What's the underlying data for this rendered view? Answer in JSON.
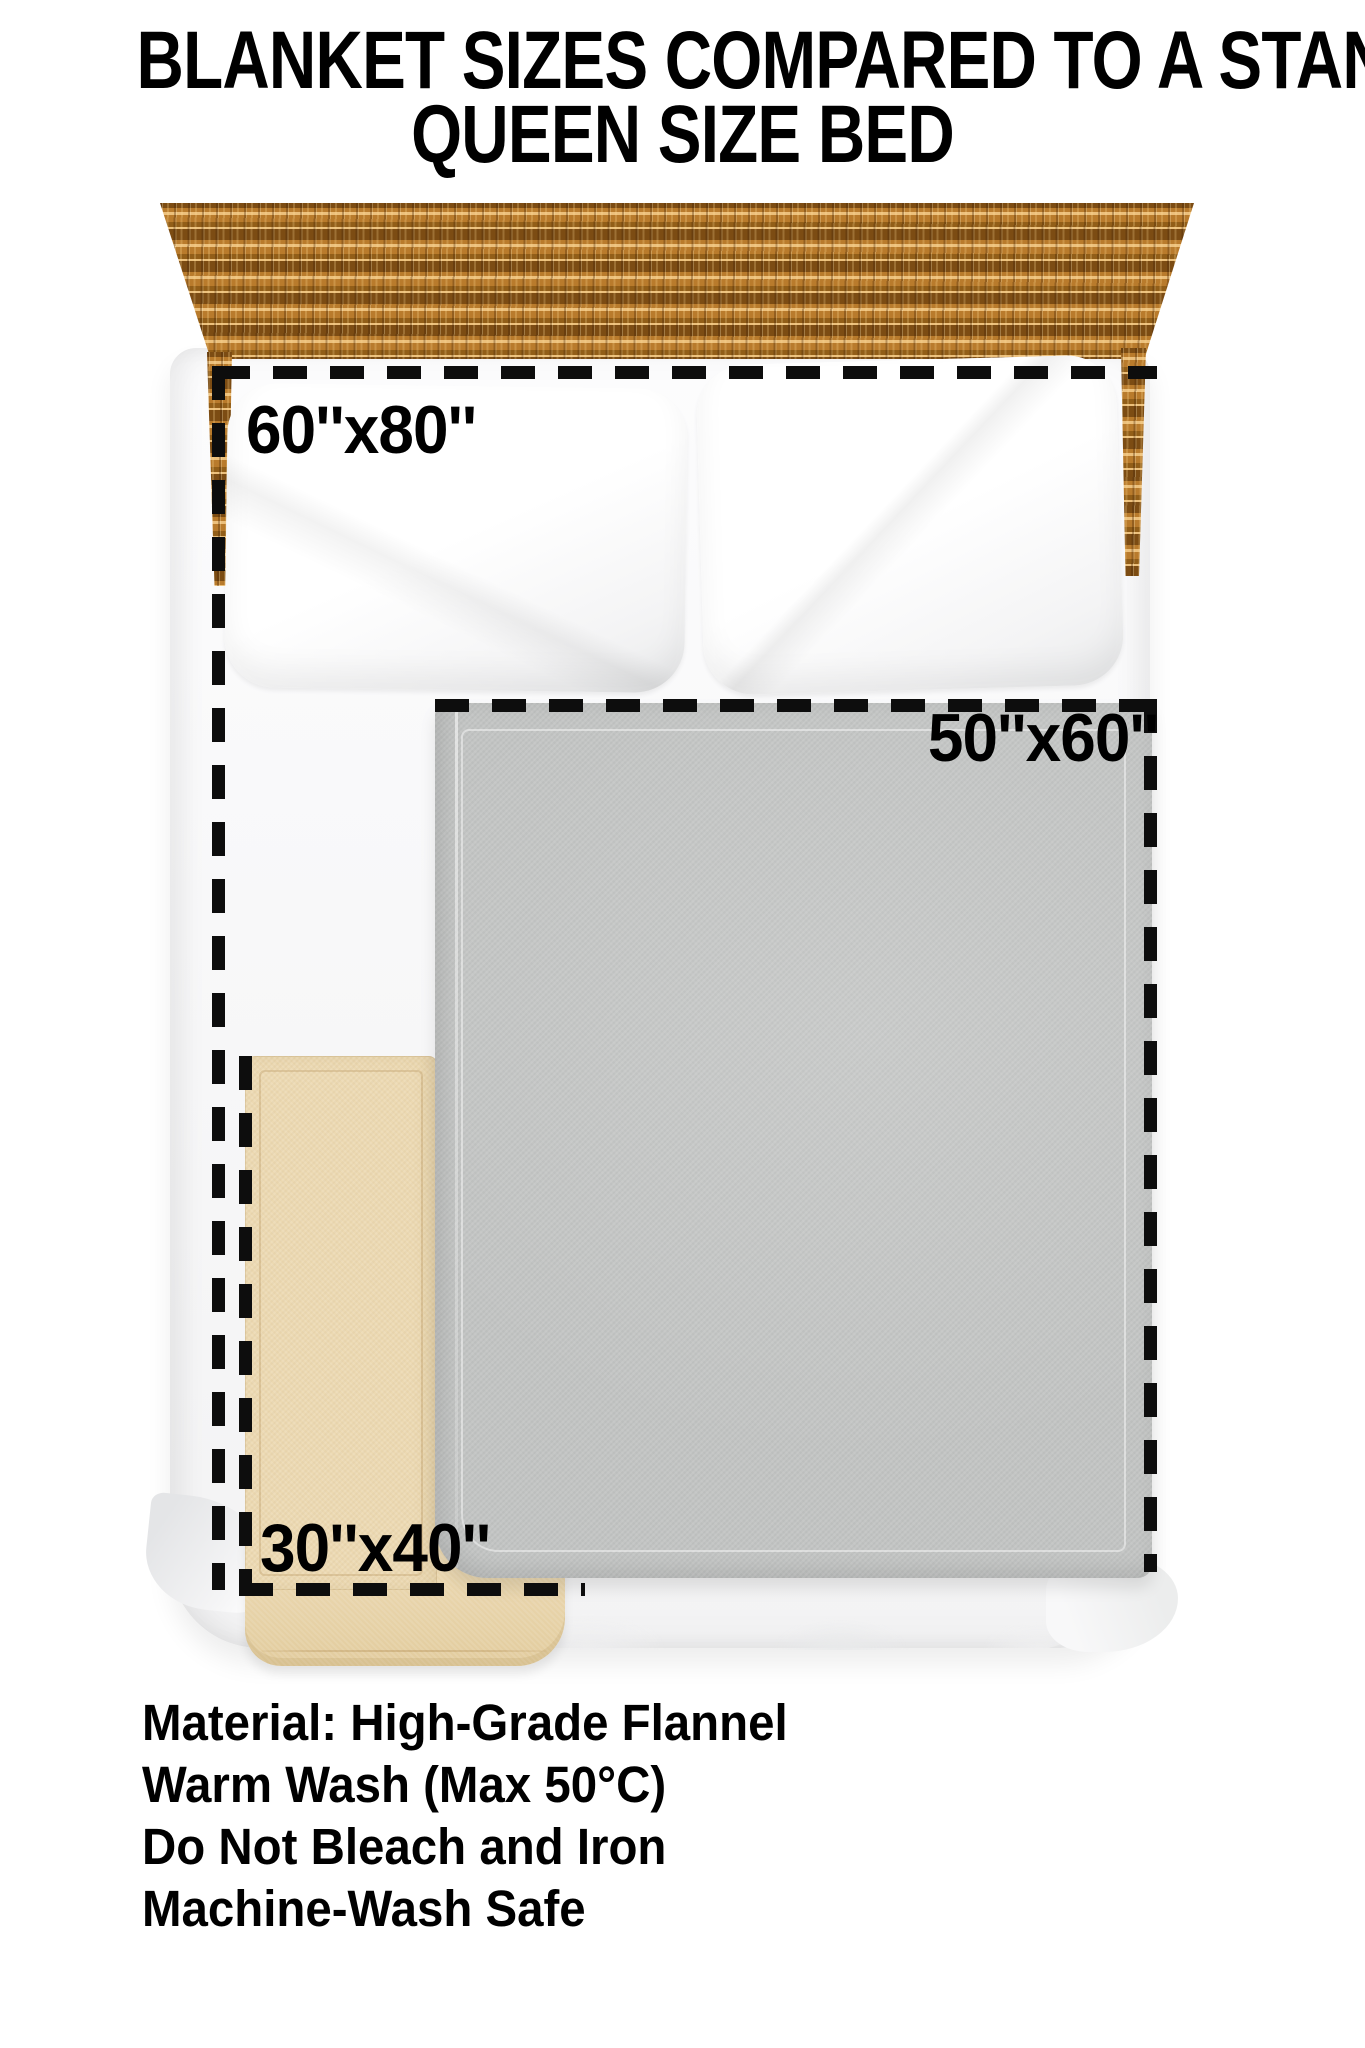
{
  "title": {
    "line1": "BLANKET SIZES COMPARED TO A STANDARD",
    "line2": "QUEEN SIZE BED"
  },
  "labels": {
    "queen_bed_size": "60''x80''",
    "medium_blanket_size": "50''x60''",
    "small_blanket_size": "30''x40''"
  },
  "care": {
    "lines": [
      "Material: High-Grade Flannel",
      "Warm Wash (Max 50°C)",
      "Do Not Bleach and Iron",
      "Machine-Wash Safe"
    ]
  },
  "colors": {
    "dash": "#0d0d0d",
    "text": "#000000",
    "wood_base": "#b97b2c",
    "wood_dark": "#7c4c13",
    "wood_light": "#ecc07c",
    "blanket_gray": "#c3c5c4",
    "blanket_tan": "#ecd9b2",
    "blanket_tan_deep": "#e2cc9e",
    "bed_white": "#f9f9fa",
    "shadow_gray": "#e9eaeb"
  }
}
